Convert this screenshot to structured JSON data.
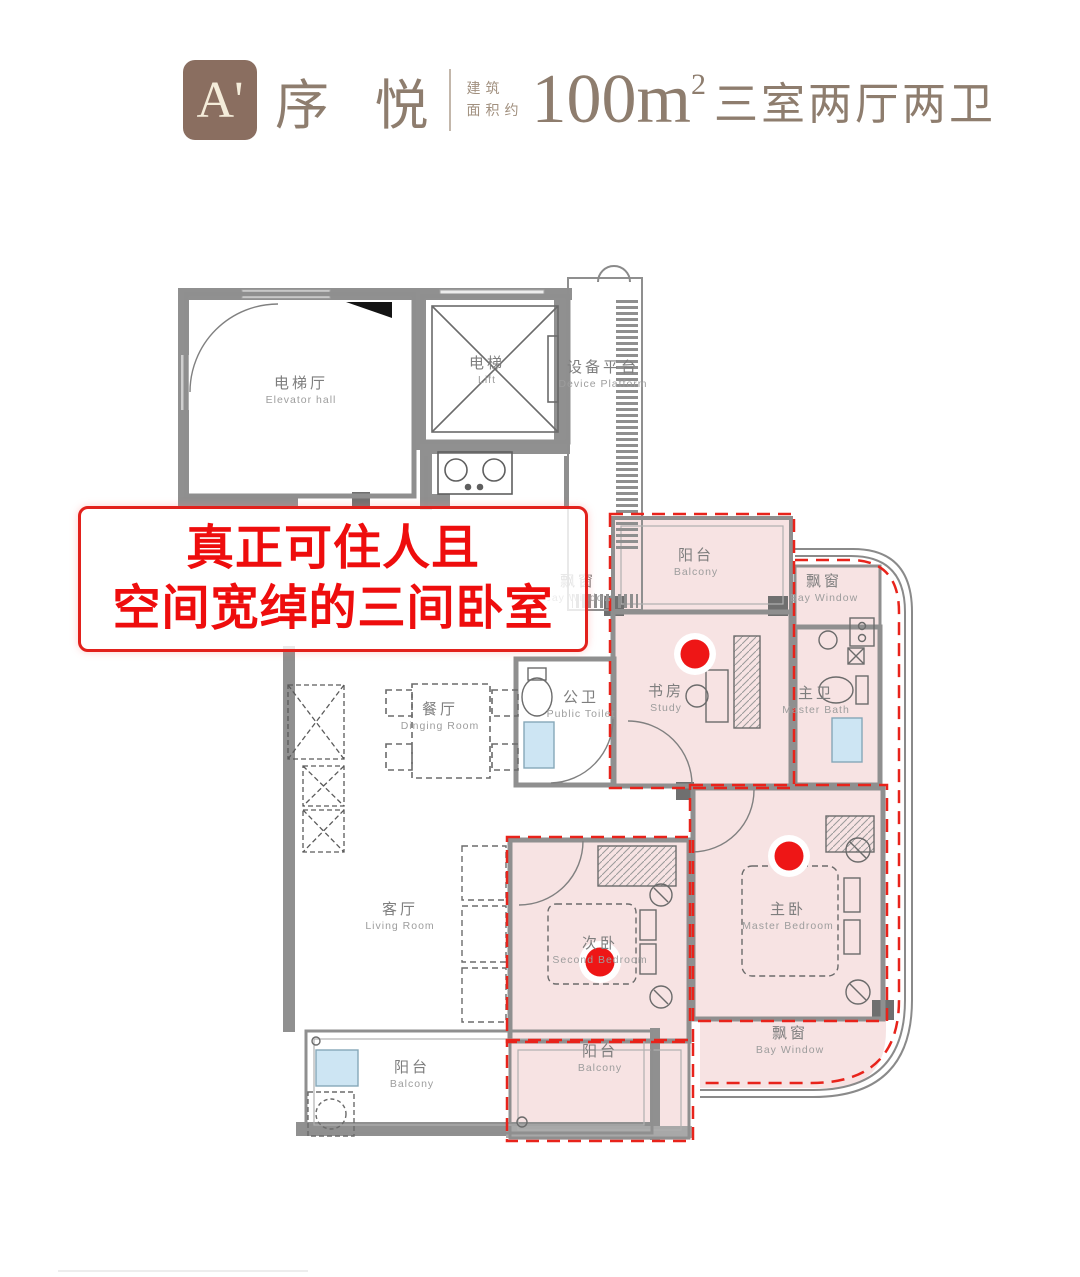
{
  "header": {
    "badge": "A'",
    "title": "序 悦",
    "area_prefix_line1": "建筑",
    "area_prefix_line2": "面积约",
    "area_value": "100m",
    "area_sup": "2",
    "layout": "三室两厅两卫"
  },
  "annotation": {
    "line1": "真正可住人且",
    "line2": "空间宽绰的三间卧室"
  },
  "rooms": {
    "elevator_hall": {
      "zh": "电梯厅",
      "en": "Elevator hall"
    },
    "lift": {
      "zh": "电梯",
      "en": "Lift"
    },
    "device_platform": {
      "zh": "设备平台",
      "en": "Device Platform"
    },
    "dining_room": {
      "zh": "餐厅",
      "en": "Dinging Room"
    },
    "public_toilet": {
      "zh": "公卫",
      "en": "Public Toilet"
    },
    "study": {
      "zh": "书房",
      "en": "Study"
    },
    "master_bath": {
      "zh": "主卫",
      "en": "Master Bath"
    },
    "living_room": {
      "zh": "客厅",
      "en": "Living Room"
    },
    "second_bedroom": {
      "zh": "次卧",
      "en": "Second Bedroom"
    },
    "master_bedroom": {
      "zh": "主卧",
      "en": "Master Bedroom"
    },
    "balcony_study": {
      "zh": "阳台",
      "en": "Balcony"
    },
    "balcony_left": {
      "zh": "阳台",
      "en": "Balcony"
    },
    "balcony_middle": {
      "zh": "阳台",
      "en": "Balcony"
    },
    "bay_window_top": {
      "zh": "飘窗",
      "en": "Bay Window"
    },
    "bay_window_right": {
      "zh": "飘窗",
      "en": "Bay Window"
    },
    "bay_window_bottom": {
      "zh": "飘窗",
      "en": "Bay Window"
    }
  },
  "colors": {
    "accent_red": "#e8231b",
    "highlight_pink": "#f7e3e3",
    "wall_gray": "#909090",
    "header_brown": "#8e7d6e",
    "badge_bg": "#8a6e60",
    "fixture_blue": "#cde5f3"
  }
}
